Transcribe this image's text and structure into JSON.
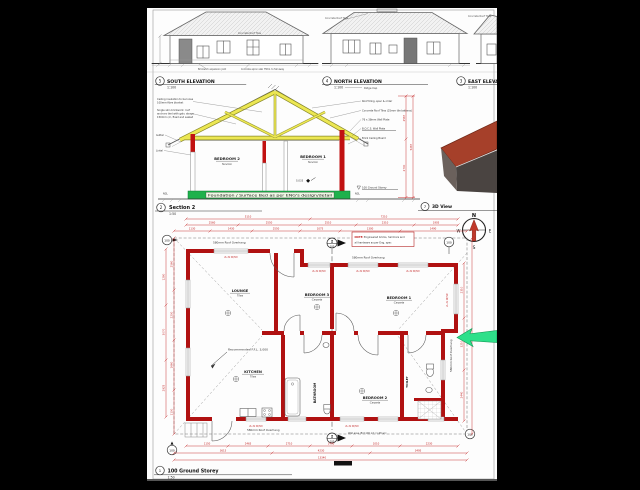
{
  "colors": {
    "wall_red": "#b01111",
    "dim_red": "#c22222",
    "truss_yellow": "#ece752",
    "foundation_green": "#1eb14c",
    "roof_3d": "#a6402a",
    "pointer_green": "#2ee08a",
    "compass_red": "#c0392b"
  },
  "elevations": {
    "roof_note": "Concrete Roof Tiles",
    "ground_note1": "Brickwork expansion joint",
    "ground_note2": "Concrete apron slab 75thk. to fall away",
    "south": {
      "ref": "5",
      "title": "SOUTH ELEVATION",
      "scale": "1:100"
    },
    "north": {
      "ref": "4",
      "title": "NORTH ELEVATION",
      "scale": "1:100"
    },
    "east": {
      "ref": "3",
      "title": "EAST ELEVATION",
      "scale": "1:100"
    }
  },
  "section": {
    "ref": "2",
    "title": "Section 2",
    "scale": "1:50",
    "ridge_cap": "Ridge Cap",
    "room_left": "BEDROOM 2",
    "room_left_sub": "Novilon",
    "room_right": "BEDROOM 1",
    "room_right_sub": "Novilon",
    "sans_mark": "S.033",
    "foundation": "Foundation / Surface Bed as per ENG's design/detail",
    "datum": "100 Ground Storey",
    "gutter": "Gutter",
    "lintel": "Lintel",
    "ngl": "NGL",
    "callouts_left_a": [
      "Ceiling insulation to be loose",
      "100mm fibre blanket"
    ],
    "callouts_left_b": [
      "Single skin brickwork: roof",
      "anchors tied with galv. straps",
      "150mm c/c, fixed and sealed"
    ],
    "callouts_right": [
      "Roof tiling, spec & order",
      "Concrete Roof Tiles (25mm tile battens)",
      "76 x 38mm Wall Plate",
      "B.O.C.S. Wall Plate",
      "Brick Ceiling Board"
    ],
    "dim_upper": "2567",
    "dim_lower": "2700",
    "dim_overall": "5267"
  },
  "view3d": {
    "ref": "7",
    "title": "3D View"
  },
  "compass": {
    "n": "N",
    "e": "E",
    "s": "S",
    "w": "W"
  },
  "plan": {
    "ref": "1",
    "title": "100 Ground Storey",
    "scale": "1:50",
    "balloon": "100",
    "marker_no": "2",
    "marker_sheet": "100",
    "overhang": "580mm Roof Overhang",
    "ffl": "Recommended F.F.L. 3,000",
    "note_prefix": "NOTE:",
    "note_line1": "Engineered bricks, hardcore and",
    "note_line2": "all hardware as per Eng. spec",
    "wall_note": "Wall area (Ext 100 int.) 1:48 w/c",
    "lintel_tag": "2L.3k W/Hdr",
    "rooms": {
      "lounge": {
        "name": "LOUNGE",
        "sub": "Tiles"
      },
      "bedroom3": {
        "name": "BEDROOM 3",
        "sub": "Carpets"
      },
      "bedroom1": {
        "name": "BEDROOM 1",
        "sub": "Carpets"
      },
      "kitchen": {
        "name": "KITCHEN",
        "sub": "Tiles"
      },
      "bathroom": {
        "name": "BATHROOM"
      },
      "bedroom2": {
        "name": "BEDROOM 2",
        "sub": "Carpets"
      },
      "toilet": {
        "name": "TOILET"
      }
    },
    "dims_top1": [
      "5110",
      "7210"
    ],
    "dims_top2": [
      "2560",
      "2550",
      "2510",
      "2310",
      "1905"
    ],
    "dims_top3": [
      "1130",
      "1430",
      "2550",
      "1075",
      "1300",
      "1490"
    ],
    "dims_bottom1": [
      "1150",
      "2465",
      "2710",
      "1490",
      "1010",
      "2230"
    ],
    "dims_bottom2": [
      "3615",
      "4230",
      "3495"
    ],
    "dims_bottom_overall": "13340",
    "dims_left1": [
      "1280",
      "3070",
      "2925"
    ],
    "dims_left2": [
      "2560",
      "2200",
      "1660",
      "1100"
    ],
    "dims_right1": [
      "2310",
      "3210",
      "2440"
    ],
    "dims_right2": [
      "8030"
    ]
  }
}
